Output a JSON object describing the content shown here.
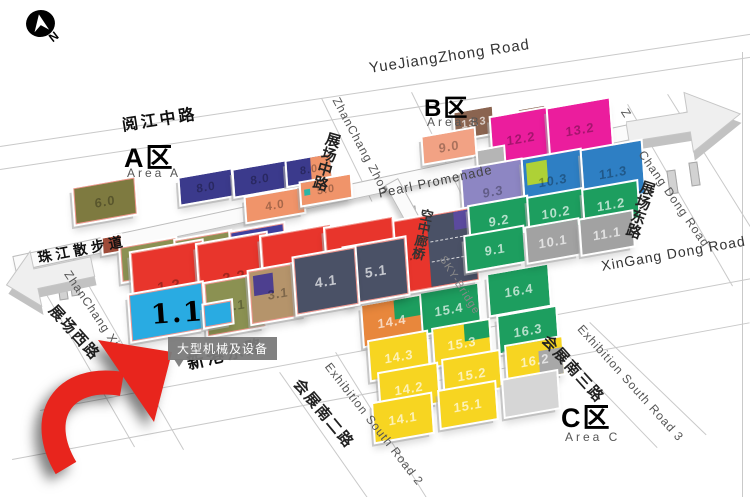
{
  "compass": {
    "label": "N"
  },
  "areas": {
    "a": {
      "name": "A区",
      "sub": "Area A"
    },
    "b": {
      "name": "B区",
      "sub": "Area B"
    },
    "c": {
      "name": "C区",
      "sub": "Area C"
    }
  },
  "roads": {
    "yuejiangzhong": {
      "en": "YueJiangZhong Road",
      "zh": "阅江中路"
    },
    "zhanchang_zhong": {
      "en": "ZhanChang Zhon",
      "zh": "展场中路"
    },
    "pearl_promenade": {
      "en": "Pearl Promenade",
      "zh": "珠江散步道"
    },
    "sky_bridge": {
      "en": "SKY-Bridge",
      "zh": "空中廊桥"
    },
    "chang_dong": {
      "prefix": "Z",
      "en": "Chang Dong Road",
      "zh": "展场东路"
    },
    "xingang": {
      "en": "XinGang Dong Road",
      "zh": "新港东路"
    },
    "zhanchang_xi": {
      "en": "ZhanChang Xi Road",
      "zh": "展场西路"
    },
    "exhibition_south_2": {
      "en": "Exhibition South Road 2",
      "zh": "会展南二路"
    },
    "exhibition_south_3": {
      "en": "Exhibition South Road 3",
      "zh": "会展南三路"
    }
  },
  "highlight": {
    "hall_label": "1.1",
    "tooltip": "大型机械及设备"
  },
  "colors": {
    "highlight_hall": "#29abe2",
    "selected_ring": "#f2968e",
    "arrow_red": "#e8251d",
    "red_hall": "#e8352c",
    "magenta_hall": "#eb1d9d",
    "green_hall": "#1d9e5f",
    "yellow_hall": "#f7d521",
    "blue_hall": "#2e7fc4",
    "salmon_hall": "#f2a284",
    "navy_hall": "#3b3a8c",
    "olive_hall": "#8b9152",
    "slate_hall": "#4a5166"
  },
  "halls": [
    {
      "label": "6.0",
      "x": 74,
      "y": 183,
      "w": 60,
      "h": 34,
      "c": "#7e7a40",
      "z": 3,
      "lc": "d",
      "ring": true,
      "fs": 13
    },
    {
      "label": "",
      "id": "block-a1",
      "x": 103,
      "y": 237,
      "w": 18,
      "h": 15,
      "c": "#9e4a38",
      "z": 3
    },
    {
      "label": "8.0",
      "id": "hall-8.0-a",
      "x": 180,
      "y": 174,
      "w": 52,
      "h": 26,
      "c": "#3b3a8c",
      "z": 3,
      "lc": "d",
      "fs": 12
    },
    {
      "label": "8.0",
      "id": "hall-8.0-b",
      "x": 234,
      "y": 166,
      "w": 52,
      "h": 26,
      "c": "#3b3a8c",
      "z": 3,
      "lc": "d",
      "fs": 12
    },
    {
      "label": "8.0",
      "id": "hall-8.0-c",
      "x": 287,
      "y": 158,
      "w": 44,
      "h": 24,
      "c": "#3b3a8c",
      "z": 3,
      "lc": "d",
      "fs": 11,
      "kids": [
        {
          "x": 55,
          "y": 0,
          "w": 45,
          "h": 100,
          "c": "#f0946a"
        }
      ]
    },
    {
      "label": "4.0",
      "x": 246,
      "y": 193,
      "w": 58,
      "h": 24,
      "c": "#f0946a",
      "z": 4,
      "lc": "d",
      "fs": 12
    },
    {
      "label": "5.0",
      "x": 301,
      "y": 179,
      "w": 50,
      "h": 22,
      "c": "#f0946a",
      "z": 4,
      "lc": "d",
      "fs": 11,
      "kids": [
        {
          "x": 5,
          "y": 34,
          "w": 13,
          "h": 26,
          "c": "#2ab5a5"
        }
      ]
    },
    {
      "label": "6.1",
      "x": 121,
      "y": 243,
      "w": 54,
      "h": 32,
      "c": "#8b9152",
      "z": 4,
      "lc": "d",
      "ring": true,
      "fs": 12
    },
    {
      "label": "7.1",
      "x": 176,
      "y": 236,
      "w": 54,
      "h": 32,
      "c": "#8b9152",
      "z": 4,
      "lc": "d",
      "ring": true,
      "fs": 12
    },
    {
      "label": "8.1",
      "x": 231,
      "y": 228,
      "w": 52,
      "h": 32,
      "c": "#3f3f9e",
      "z": 4,
      "lc": "l",
      "ring": true,
      "fs": 12
    },
    {
      "label": "1.2",
      "x": 133,
      "y": 247,
      "w": 70,
      "h": 76,
      "c": "#e8352c",
      "z": 8,
      "lc": "d",
      "ring": true,
      "fs": 15
    },
    {
      "label": "2.2",
      "x": 199,
      "y": 239,
      "w": 68,
      "h": 74,
      "c": "#e8352c",
      "z": 8,
      "lc": "d",
      "ring": true,
      "fs": 15
    },
    {
      "label": "3.2",
      "x": 263,
      "y": 231,
      "w": 68,
      "h": 72,
      "c": "#e8352c",
      "z": 8,
      "lc": "d",
      "ring": true,
      "fs": 15
    },
    {
      "label": "4.2",
      "x": 327,
      "y": 223,
      "w": 66,
      "h": 70,
      "c": "#e8352c",
      "z": 8,
      "lc": "d",
      "ring": true,
      "fs": 15
    },
    {
      "label": "5.2",
      "x": 391,
      "y": 215,
      "w": 84,
      "h": 70,
      "c": "#e8352c",
      "z": 7,
      "lc": "d",
      "ring": true,
      "fs": 14,
      "lp": "left",
      "dash": true,
      "kids": [
        {
          "x": 44,
          "y": 0,
          "w": 56,
          "h": 100,
          "c": "#4a5166"
        },
        {
          "x": 76,
          "y": 0,
          "w": 24,
          "h": 26,
          "c": "#5b4a9e"
        }
      ]
    },
    {
      "label": "",
      "id": "hall-1.1",
      "x": 130,
      "y": 289,
      "w": 72,
      "h": 44,
      "c": "#29abe2",
      "z": 10,
      "ring": true
    },
    {
      "label": "",
      "id": "hall-1.1-annex",
      "x": 204,
      "y": 303,
      "w": 26,
      "h": 20,
      "c": "#29abe2",
      "z": 11,
      "ring": true
    },
    {
      "label": "2.1",
      "x": 206,
      "y": 279,
      "w": 56,
      "h": 50,
      "c": "#8b9152",
      "z": 9,
      "lc": "d",
      "ring": true,
      "fs": 13
    },
    {
      "label": "3.1",
      "x": 250,
      "y": 267,
      "w": 54,
      "h": 50,
      "c": "#b5946b",
      "z": 9,
      "lc": "d",
      "ring": true,
      "fs": 13,
      "kids": [
        {
          "x": 6,
          "y": 8,
          "w": 36,
          "h": 40,
          "c": "#4d3f8f"
        }
      ]
    },
    {
      "label": "4.1",
      "x": 295,
      "y": 253,
      "w": 60,
      "h": 54,
      "c": "#4a5166",
      "z": 9,
      "lc": "l",
      "ring": true,
      "fs": 14
    },
    {
      "label": "5.1",
      "x": 345,
      "y": 243,
      "w": 60,
      "h": 54,
      "c": "#4a5166",
      "z": 8,
      "lc": "l",
      "ring": true,
      "fs": 14
    },
    {
      "label": "13.3",
      "x": 455,
      "y": 110,
      "w": 38,
      "h": 26,
      "c": "#8a6450",
      "z": 3,
      "lc": "l",
      "fs": 11
    },
    {
      "label": "",
      "id": "block-b1",
      "x": 519,
      "y": 108,
      "w": 26,
      "h": 15,
      "c": "#8a6450",
      "z": 3
    },
    {
      "label": "9.0",
      "x": 423,
      "y": 133,
      "w": 52,
      "h": 26,
      "c": "#f2a284",
      "z": 4,
      "lc": "d",
      "fs": 13
    },
    {
      "label": "12.2",
      "x": 492,
      "y": 113,
      "w": 58,
      "h": 50,
      "c": "#eb1d9d",
      "z": 5,
      "lc": "d",
      "fs": 13
    },
    {
      "label": "13.2",
      "x": 549,
      "y": 104,
      "w": 62,
      "h": 50,
      "c": "#eb1d9d",
      "z": 5,
      "lc": "d",
      "fs": 13
    },
    {
      "label": "",
      "id": "block-b2",
      "x": 478,
      "y": 149,
      "w": 26,
      "h": 16,
      "c": "#b5b5b5",
      "z": 5
    },
    {
      "label": "9.3",
      "x": 463,
      "y": 165,
      "w": 60,
      "h": 52,
      "c": "#8d86c3",
      "z": 6,
      "lc": "d",
      "fs": 13
    },
    {
      "label": "10.3",
      "x": 524,
      "y": 155,
      "w": 58,
      "h": 50,
      "c": "#2e7fc4",
      "z": 6,
      "lc": "d",
      "fs": 13,
      "kids": [
        {
          "x": 6,
          "y": 8,
          "w": 36,
          "h": 44,
          "c": "#aed136"
        }
      ]
    },
    {
      "label": "11.3",
      "x": 583,
      "y": 146,
      "w": 60,
      "h": 52,
      "c": "#2e7fc4",
      "z": 6,
      "lc": "d",
      "fs": 13
    },
    {
      "label": "9.2",
      "x": 470,
      "y": 202,
      "w": 58,
      "h": 36,
      "c": "#1d9e5f",
      "z": 7,
      "lc": "l",
      "fs": 13
    },
    {
      "label": "10.2",
      "x": 529,
      "y": 194,
      "w": 54,
      "h": 36,
      "c": "#1d9e5f",
      "z": 7,
      "lc": "l",
      "fs": 13
    },
    {
      "label": "11.2",
      "x": 584,
      "y": 186,
      "w": 54,
      "h": 36,
      "c": "#1d9e5f",
      "z": 7,
      "lc": "l",
      "fs": 13
    },
    {
      "label": "9.1",
      "x": 466,
      "y": 232,
      "w": 58,
      "h": 34,
      "c": "#1d9e5f",
      "z": 8,
      "lc": "l",
      "fs": 13
    },
    {
      "label": "10.1",
      "x": 527,
      "y": 224,
      "w": 52,
      "h": 34,
      "c": "#a2a2a2",
      "z": 8,
      "lc": "l",
      "fs": 13
    },
    {
      "label": "11.1",
      "x": 581,
      "y": 216,
      "w": 52,
      "h": 34,
      "c": "#a2a2a2",
      "z": 8,
      "lc": "l",
      "fs": 13
    },
    {
      "label": "16.4",
      "x": 489,
      "y": 270,
      "w": 60,
      "h": 40,
      "c": "#1d9e5f",
      "z": 6,
      "lc": "l",
      "fs": 13
    },
    {
      "label": "15.4",
      "x": 419,
      "y": 289,
      "w": 60,
      "h": 40,
      "c": "#1d9e5f",
      "z": 6,
      "lc": "l",
      "fs": 13
    },
    {
      "label": "14.4",
      "x": 363,
      "y": 301,
      "w": 58,
      "h": 40,
      "c": "#e8873c",
      "z": 6,
      "lc": "l",
      "fs": 13,
      "kids": [
        {
          "x": 56,
          "y": 0,
          "w": 44,
          "h": 48,
          "c": "#1d9e5f"
        }
      ]
    },
    {
      "label": "16.3",
      "x": 499,
      "y": 312,
      "w": 58,
      "h": 36,
      "c": "#1d9e5f",
      "z": 7,
      "lc": "l",
      "fs": 13
    },
    {
      "label": "15.3",
      "x": 434,
      "y": 325,
      "w": 56,
      "h": 36,
      "c": "#f7d521",
      "z": 7,
      "lc": "l",
      "fs": 13,
      "kids": [
        {
          "x": 56,
          "y": 0,
          "w": 44,
          "h": 46,
          "c": "#1d9e5f"
        }
      ]
    },
    {
      "label": "14.3",
      "x": 370,
      "y": 337,
      "w": 58,
      "h": 38,
      "c": "#f7d521",
      "z": 7,
      "lc": "l",
      "fs": 13
    },
    {
      "label": "16.2",
      "x": 507,
      "y": 342,
      "w": 56,
      "h": 36,
      "c": "#f7d521",
      "z": 8,
      "lc": "l",
      "fs": 13,
      "kids": [
        {
          "x": 58,
          "y": 28,
          "w": 42,
          "h": 72,
          "c": "#a8a8a8"
        }
      ]
    },
    {
      "label": "15.2",
      "x": 444,
      "y": 356,
      "w": 56,
      "h": 36,
      "c": "#f7d521",
      "z": 8,
      "lc": "l",
      "fs": 13
    },
    {
      "label": "14.2",
      "x": 380,
      "y": 369,
      "w": 58,
      "h": 38,
      "c": "#f7d521",
      "z": 8,
      "lc": "l",
      "fs": 13
    },
    {
      "label": "",
      "id": "block-c1",
      "x": 504,
      "y": 376,
      "w": 54,
      "h": 36,
      "c": "#d6d6d6",
      "z": 9
    },
    {
      "label": "15.1",
      "x": 440,
      "y": 387,
      "w": 56,
      "h": 36,
      "c": "#f7d521",
      "z": 9,
      "lc": "l",
      "fs": 13
    },
    {
      "label": "14.1",
      "x": 374,
      "y": 399,
      "w": 58,
      "h": 38,
      "c": "#f7d521",
      "z": 9,
      "lc": "l",
      "fs": 13
    }
  ],
  "map_lines": [
    [
      0,
      146,
      770,
      -8.5
    ],
    [
      0,
      169,
      770,
      -8.5
    ],
    [
      40,
      410,
      725,
      -10.5
    ],
    [
      12,
      459,
      750,
      -10.5
    ],
    [
      322,
      98,
      115,
      64
    ],
    [
      412,
      92,
      120,
      64
    ],
    [
      628,
      104,
      210,
      60
    ],
    [
      668,
      94,
      205,
      58
    ],
    [
      26,
      258,
      218,
      60
    ],
    [
      70,
      252,
      228,
      60
    ],
    [
      336,
      352,
      172,
      58
    ],
    [
      280,
      372,
      178,
      55
    ],
    [
      590,
      322,
      162,
      44
    ],
    [
      552,
      338,
      152,
      46
    ],
    [
      743,
      52,
      446,
      90
    ]
  ],
  "legs": [
    [
      58,
      276
    ],
    [
      70,
      272
    ],
    [
      408,
      206
    ],
    [
      422,
      232
    ],
    [
      437,
      258
    ],
    [
      668,
      170
    ],
    [
      690,
      162
    ]
  ]
}
